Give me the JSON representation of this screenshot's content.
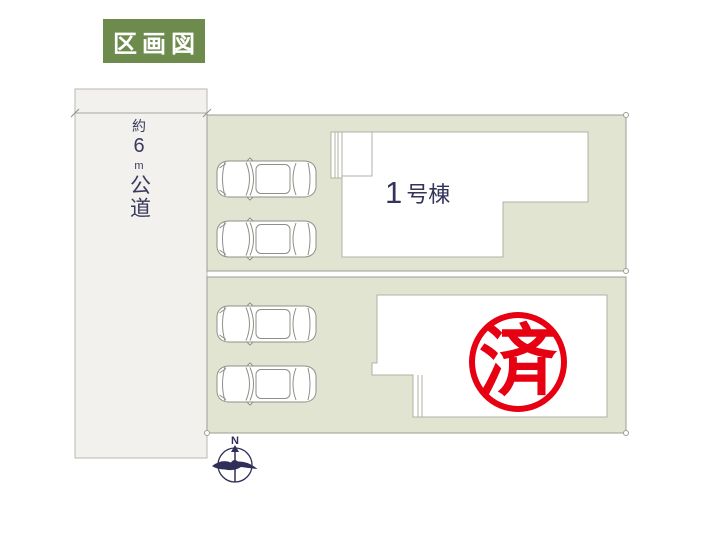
{
  "header": {
    "badge_label": "区画図"
  },
  "road": {
    "approx": "約",
    "width_value": "6",
    "unit": "m",
    "type": "公道",
    "full_label": "約6m公道"
  },
  "plots": {
    "plot1": {
      "building": {
        "number": "1",
        "suffix": "号棟",
        "full_label": "1号棟"
      },
      "parking_spaces": 2
    },
    "plot2": {
      "stamp_label": "済",
      "parking_spaces": 2
    }
  },
  "compass": {
    "north_label": "N"
  },
  "colors": {
    "badge_green": "#6d8b4c",
    "plot_fill": "#e1e4d1",
    "road_fill": "#f2f1ed",
    "ink_navy": "#34345a",
    "stamp_red": "#e60012"
  }
}
